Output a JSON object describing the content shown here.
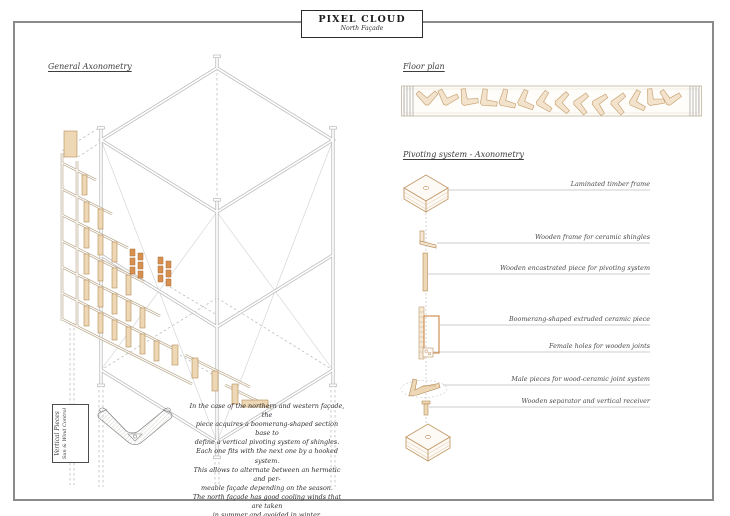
{
  "page": {
    "title": "PIXEL CLOUD",
    "subtitle": "North Façade"
  },
  "sections": {
    "general_axonometry": {
      "heading": "General Axonometry"
    },
    "floor_plan": {
      "heading": "Floor plan"
    },
    "pivoting_system": {
      "heading": "Pivoting system - Axonometry",
      "labels": [
        "Laminated timber frame",
        "Wooden frame for ceramic shingles",
        "Wooden encastrated piece for pivoting system",
        "Boomerang-shaped extruded ceramic piece",
        "Female holes for wooden joints",
        "Male pieces for wood-ceramic joint system",
        "Wooden separator and vertical receiver"
      ]
    },
    "detail": {
      "box_line1": "Vertical Pieces",
      "box_line2": "Sun & Wind Control"
    },
    "description": {
      "lines": [
        "In the case of the northern and western façade, the",
        "piece acquires a boomerang-shaped section base to",
        "define a vertical pivoting system of shingles.",
        "Each one fits with the next one by a hooked system.",
        "This allows to alternate between an hermetic and per-",
        "meable façade depending on the season.",
        "The north façade has good cooling winds that are taken",
        "in summer and avoided in winter."
      ]
    }
  },
  "colors": {
    "wood_stroke": "#b98f5e",
    "wood_fill": "#eed7b4",
    "ceramic_orange": "#cd8544",
    "line_gray": "#b8b8b8",
    "border_gray": "#8a8a8a",
    "text_dark": "#1d1d1d",
    "text_gray": "#4a4a4a"
  }
}
